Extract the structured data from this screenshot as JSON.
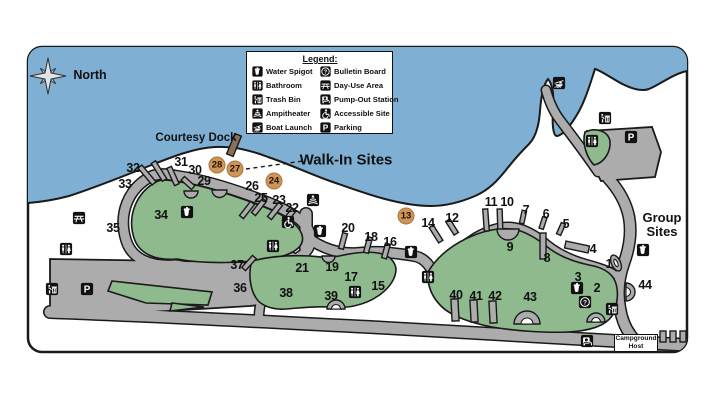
{
  "compass": {
    "label": "North"
  },
  "legend": {
    "title": "Legend:",
    "columns": [
      {
        "items": [
          {
            "icon": "water-spigot",
            "label": "Water Spigot"
          },
          {
            "icon": "bathroom",
            "label": "Bathroom"
          },
          {
            "icon": "trash-bin",
            "label": "Trash Bin"
          },
          {
            "icon": "amphitheater",
            "label": "Ampitheater"
          },
          {
            "icon": "boat-launch",
            "label": "Boat Launch"
          }
        ]
      },
      {
        "items": [
          {
            "icon": "bulletin-board",
            "label": "Bulletin Board"
          },
          {
            "icon": "day-use",
            "label": "Day-Use Area"
          },
          {
            "icon": "pump-out",
            "label": "Pump-Out Station"
          },
          {
            "icon": "accessible",
            "label": "Accessible Site"
          },
          {
            "icon": "parking",
            "label": "Parking"
          }
        ]
      }
    ]
  },
  "map_labels": {
    "courtesy_dock": "Courtesy Dock",
    "walk_in_sites": "Walk-In Sites",
    "group_sites_line1": "Group",
    "group_sites_line2": "Sites",
    "campground_host_line1": "Campground",
    "campground_host_line2": "Host"
  },
  "numbered_sites": [
    {
      "n": "1",
      "x": 609,
      "y": 264
    },
    {
      "n": "2",
      "x": 597,
      "y": 288
    },
    {
      "n": "3",
      "x": 578,
      "y": 277
    },
    {
      "n": "4",
      "x": 593,
      "y": 249
    },
    {
      "n": "5",
      "x": 566,
      "y": 224
    },
    {
      "n": "6",
      "x": 546,
      "y": 214
    },
    {
      "n": "7",
      "x": 526,
      "y": 210
    },
    {
      "n": "8",
      "x": 547,
      "y": 258
    },
    {
      "n": "9",
      "x": 510,
      "y": 247
    },
    {
      "n": "10",
      "x": 507,
      "y": 202
    },
    {
      "n": "11",
      "x": 491,
      "y": 202
    },
    {
      "n": "12",
      "x": 452,
      "y": 218
    },
    {
      "n": "14",
      "x": 428,
      "y": 223
    },
    {
      "n": "15",
      "x": 378,
      "y": 286
    },
    {
      "n": "16",
      "x": 390,
      "y": 242
    },
    {
      "n": "17",
      "x": 351,
      "y": 277
    },
    {
      "n": "18",
      "x": 371,
      "y": 237
    },
    {
      "n": "19",
      "x": 332,
      "y": 267
    },
    {
      "n": "20",
      "x": 348,
      "y": 228
    },
    {
      "n": "21",
      "x": 302,
      "y": 268
    },
    {
      "n": "22",
      "x": 292,
      "y": 208
    },
    {
      "n": "23",
      "x": 279,
      "y": 200
    },
    {
      "n": "25",
      "x": 261,
      "y": 198
    },
    {
      "n": "26",
      "x": 252,
      "y": 186
    },
    {
      "n": "29",
      "x": 204,
      "y": 181
    },
    {
      "n": "30",
      "x": 195,
      "y": 170
    },
    {
      "n": "31",
      "x": 181,
      "y": 162
    },
    {
      "n": "32",
      "x": 133,
      "y": 168
    },
    {
      "n": "33",
      "x": 125,
      "y": 184
    },
    {
      "n": "34",
      "x": 161,
      "y": 215
    },
    {
      "n": "35",
      "x": 113,
      "y": 228
    },
    {
      "n": "36",
      "x": 240,
      "y": 288
    },
    {
      "n": "37",
      "x": 237,
      "y": 265
    },
    {
      "n": "38",
      "x": 286,
      "y": 293
    },
    {
      "n": "39",
      "x": 331,
      "y": 296
    },
    {
      "n": "40",
      "x": 456,
      "y": 295
    },
    {
      "n": "41",
      "x": 476,
      "y": 296
    },
    {
      "n": "42",
      "x": 495,
      "y": 296
    },
    {
      "n": "43",
      "x": 530,
      "y": 297
    },
    {
      "n": "44",
      "x": 645,
      "y": 285
    }
  ],
  "walk_in_sites": [
    {
      "n": "13",
      "x": 406,
      "y": 216
    },
    {
      "n": "24",
      "x": 274,
      "y": 181
    },
    {
      "n": "27",
      "x": 235,
      "y": 169
    },
    {
      "n": "28",
      "x": 217,
      "y": 165
    }
  ],
  "amenity_icons": [
    {
      "type": "water-spigot",
      "x": 187,
      "y": 212
    },
    {
      "type": "water-spigot",
      "x": 320,
      "y": 231
    },
    {
      "type": "water-spigot",
      "x": 411,
      "y": 252
    },
    {
      "type": "water-spigot",
      "x": 577,
      "y": 288
    },
    {
      "type": "water-spigot",
      "x": 643,
      "y": 250
    },
    {
      "type": "bathroom",
      "x": 66,
      "y": 249
    },
    {
      "type": "bathroom",
      "x": 273,
      "y": 246
    },
    {
      "type": "bathroom",
      "x": 355,
      "y": 292
    },
    {
      "type": "bathroom",
      "x": 428,
      "y": 277
    },
    {
      "type": "bathroom",
      "x": 592,
      "y": 141
    },
    {
      "type": "trash-bin",
      "x": 52,
      "y": 289
    },
    {
      "type": "trash-bin",
      "x": 605,
      "y": 118
    },
    {
      "type": "trash-bin",
      "x": 612,
      "y": 309
    },
    {
      "type": "parking",
      "x": 87,
      "y": 289
    },
    {
      "type": "parking",
      "x": 631,
      "y": 137
    },
    {
      "type": "day-use",
      "x": 79,
      "y": 218
    },
    {
      "type": "amphitheater",
      "x": 313,
      "y": 200
    },
    {
      "type": "accessible",
      "x": 288,
      "y": 222
    },
    {
      "type": "boat-launch",
      "x": 559,
      "y": 83
    },
    {
      "type": "bulletin-board",
      "x": 585,
      "y": 302
    },
    {
      "type": "pump-out",
      "x": 587,
      "y": 341
    }
  ],
  "colors": {
    "water": "#7fb0d4",
    "road": "#acacac",
    "green": "#8eba8e",
    "outline": "#1a1a1a",
    "walkin": "#cf9558",
    "walkinb": "#a9763d",
    "dock": "#8a6f55",
    "icon_bg": "#111111"
  }
}
